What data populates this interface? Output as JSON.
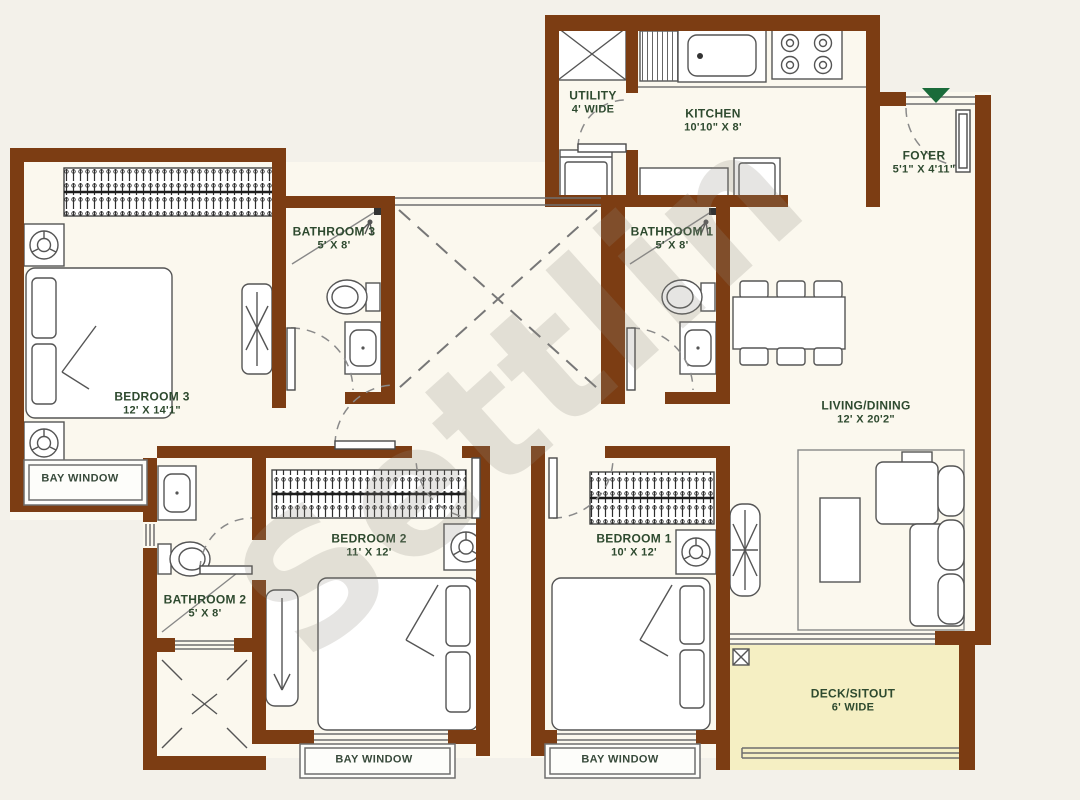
{
  "watermark": "Settlin",
  "rooms": {
    "bedroom3": {
      "name": "BEDROOM 3",
      "dims": "12' X 14'1\""
    },
    "bathroom3": {
      "name": "BATHROOM 3",
      "dims": "5' X 8'"
    },
    "utility": {
      "name": "UTILITY",
      "dims": "4' WIDE"
    },
    "kitchen": {
      "name": "KITCHEN",
      "dims": "10'10\" X 8'"
    },
    "foyer": {
      "name": "FOYER",
      "dims": "5'1\" X 4'11\""
    },
    "bathroom1": {
      "name": "BATHROOM 1",
      "dims": "5' X 8'"
    },
    "living": {
      "name": "LIVING/DINING",
      "dims": "12' X 20'2\""
    },
    "bedroom2": {
      "name": "BEDROOM 2",
      "dims": "11' X 12'"
    },
    "bedroom1": {
      "name": "BEDROOM 1",
      "dims": "10' X 12'"
    },
    "bathroom2": {
      "name": "BATHROOM 2",
      "dims": "5' X 8'"
    },
    "deck": {
      "name": "DECK/SITOUT",
      "dims": "6' WIDE"
    }
  },
  "bay_window_labels": [
    "BAY WINDOW",
    "BAY WINDOW",
    "BAY WINDOW"
  ],
  "colors": {
    "wall": "#7c3d13",
    "floor": "#fbf8ee",
    "deck_floor": "#f5efc3",
    "label_text": "#2e4a2f",
    "entry_marker": "#1a6b3a",
    "watermark": "#8f8c82"
  }
}
